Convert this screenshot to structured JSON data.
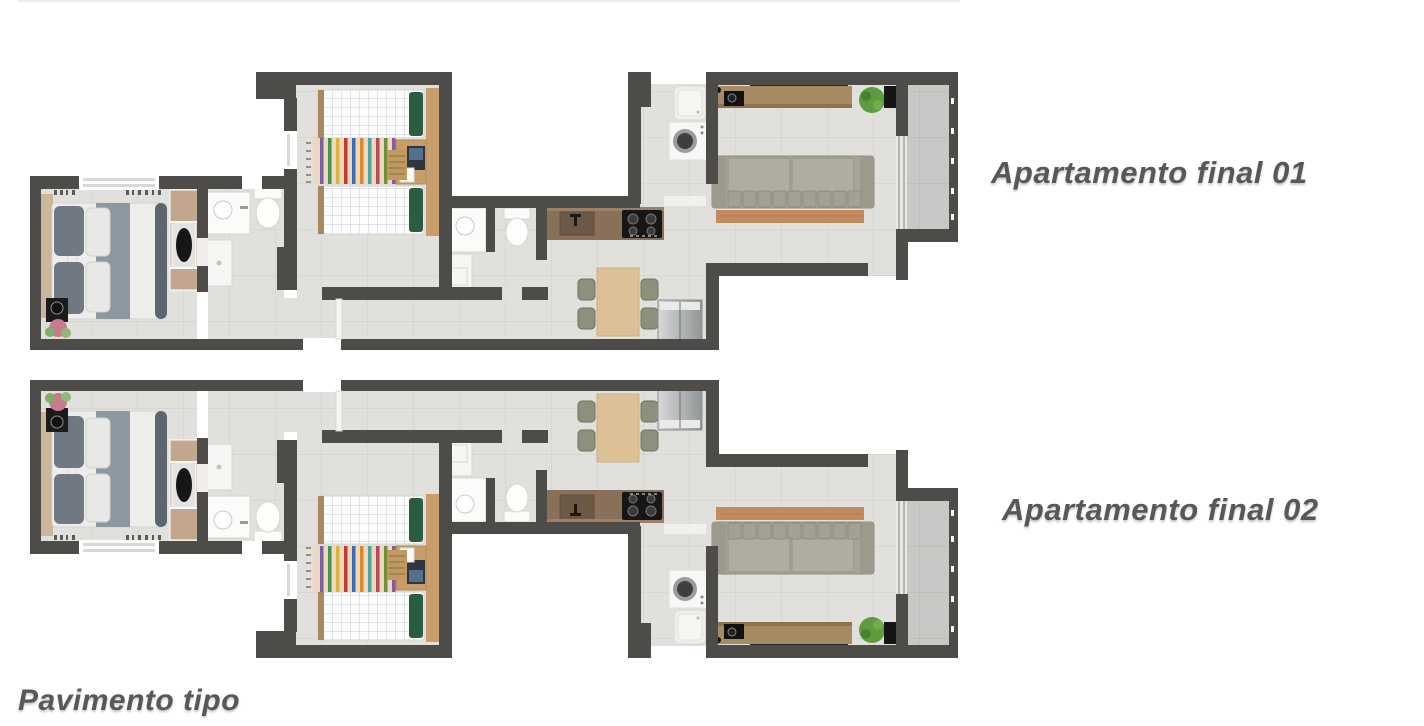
{
  "page": {
    "background": "#ffffff"
  },
  "labels": {
    "apartment_01": "Apartamento final 01",
    "apartment_02": "Apartamento final 02",
    "floor_type": "Pavimento tipo"
  },
  "plan": {
    "colors": {
      "wall": "#4e4c49",
      "floor_tile": "#e2e0dd",
      "floor_grout": "#d2d0cc",
      "balcony_tile": "#c9c8c6",
      "counter_wood": "#8a7058",
      "dining_wood": "#dcc096",
      "console_wood": "#a88a62",
      "bench_wood": "#c28b5e",
      "desk_wood": "#c79d6c",
      "sofa": "#a6a597",
      "bed_duvet": "#ededeb",
      "bed_blanket": "#8d97a2",
      "pillow_green": "#2c5d3f",
      "appliance_white": "#f7f7f5",
      "fridge_silver": "#b7babb",
      "plant_green": "#5f9c3f",
      "label_text": "#58585a"
    }
  }
}
